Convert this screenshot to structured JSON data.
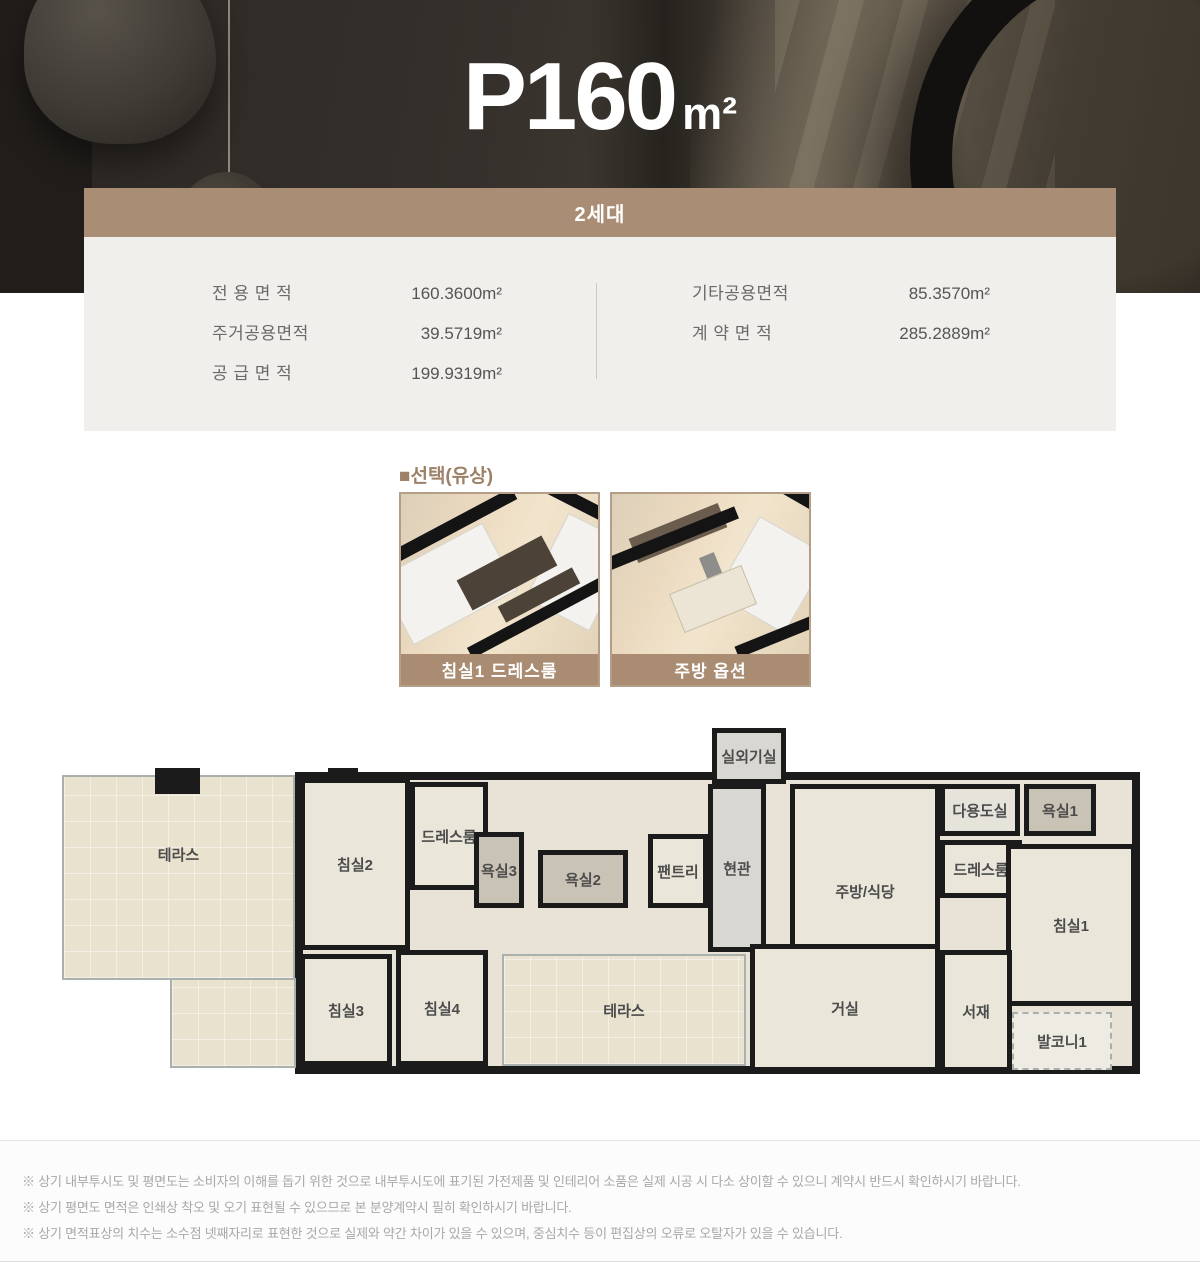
{
  "hero": {
    "title_main": "P160",
    "title_unit": "m²"
  },
  "card": {
    "header": "2세대",
    "areas_left": [
      {
        "label": "전 용 면 적",
        "value": "160.3600m²"
      },
      {
        "label": "주거공용면적",
        "value": "39.5719m²"
      },
      {
        "label": "공 급 면 적",
        "value": "199.9319m²"
      }
    ],
    "areas_right": [
      {
        "label": "기타공용면적",
        "value": "85.3570m²"
      },
      {
        "label": "계 약 면 적",
        "value": "285.2889m²"
      }
    ]
  },
  "options": {
    "section_title": "■선택(유상)",
    "items": [
      {
        "label": "침실1 드레스룸"
      },
      {
        "label": "주방 옵션"
      }
    ]
  },
  "floorplan": {
    "rooms": [
      {
        "label": "테라스",
        "x": 12,
        "y": 53,
        "w": 233,
        "h": 205,
        "type": "terrace",
        "align": "upper"
      },
      {
        "label": "",
        "x": 120,
        "y": 256,
        "w": 126,
        "h": 90,
        "type": "terrace"
      },
      {
        "label": "침실2",
        "x": 250,
        "y": 56,
        "w": 110,
        "h": 172,
        "type": "room"
      },
      {
        "label": "드레스룸",
        "x": 360,
        "y": 60,
        "w": 78,
        "h": 108,
        "type": "room"
      },
      {
        "label": "욕실3",
        "x": 424,
        "y": 110,
        "w": 50,
        "h": 76,
        "type": "bath"
      },
      {
        "label": "욕실2",
        "x": 488,
        "y": 128,
        "w": 90,
        "h": 58,
        "type": "bath"
      },
      {
        "label": "팬트리",
        "x": 598,
        "y": 112,
        "w": 60,
        "h": 74,
        "type": "room"
      },
      {
        "label": "현관",
        "x": 658,
        "y": 62,
        "w": 58,
        "h": 168,
        "type": "entry"
      },
      {
        "label": "실외기실",
        "x": 662,
        "y": 6,
        "w": 74,
        "h": 56,
        "type": "entry"
      },
      {
        "label": "주방/식당",
        "x": 740,
        "y": 62,
        "w": 150,
        "h": 215,
        "type": "room"
      },
      {
        "label": "다용도실",
        "x": 890,
        "y": 62,
        "w": 80,
        "h": 52,
        "type": "utility"
      },
      {
        "label": "드레스룸",
        "x": 890,
        "y": 118,
        "w": 82,
        "h": 58,
        "type": "room"
      },
      {
        "label": "욕실1",
        "x": 974,
        "y": 62,
        "w": 72,
        "h": 52,
        "type": "bath"
      },
      {
        "label": "침실1",
        "x": 956,
        "y": 122,
        "w": 130,
        "h": 162,
        "type": "room"
      },
      {
        "label": "침실3",
        "x": 250,
        "y": 232,
        "w": 92,
        "h": 112,
        "type": "room"
      },
      {
        "label": "침실4",
        "x": 346,
        "y": 228,
        "w": 92,
        "h": 116,
        "type": "room"
      },
      {
        "label": "테라스",
        "x": 452,
        "y": 232,
        "w": 244,
        "h": 112,
        "type": "terrace"
      },
      {
        "label": "거실",
        "x": 700,
        "y": 222,
        "w": 190,
        "h": 128,
        "type": "room"
      },
      {
        "label": "서재",
        "x": 890,
        "y": 228,
        "w": 72,
        "h": 122,
        "type": "room"
      },
      {
        "label": "발코니1",
        "x": 962,
        "y": 290,
        "w": 100,
        "h": 58,
        "type": "balcony"
      }
    ]
  },
  "footer": {
    "notes": [
      "※ 상기 내부투시도 및 평면도는 소비자의 이해를 돕기 위한 것으로 내부투시도에 표기된 가전제품 및 인테리어 소품은 실제 시공 시 다소 상이할 수 있으니 계약시 반드시 확인하시기 바랍니다.",
      "※ 상기 평면도 면적은 인쇄상 착오 및 오기 표현될 수 있으므로 본 분양계약시 필히 확인하시기 바랍니다.",
      "※ 상기 면적표상의 치수는 소수점 넷째자리로 표현한 것으로 실제와 약간 차이가 있을 수 있으며, 중심치수 등이 편집상의 오류로 오탈자가 있을 수 있습니다."
    ]
  },
  "colors": {
    "accent_brown": "#a98e75",
    "label_bar_brown": "#a98c72",
    "section_title_brown": "#9d8168",
    "card_bg": "#f1efec",
    "wall_black": "#1b1b1b",
    "room_beige": "#eae6da",
    "terrace_tan": "#e9e2cf"
  }
}
